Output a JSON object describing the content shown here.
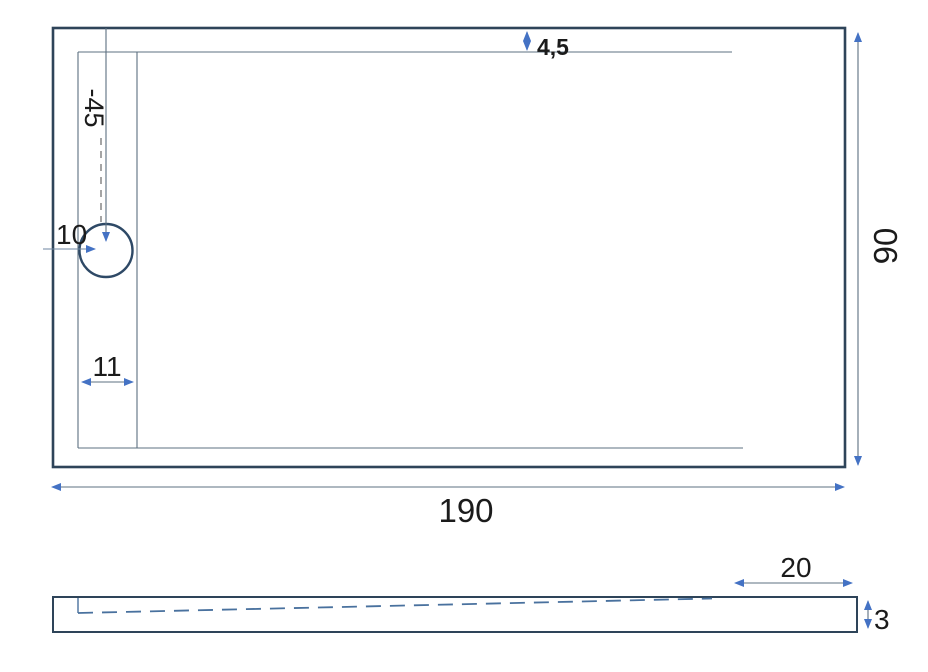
{
  "drawing": {
    "title": "shower-tray-dimension-drawing",
    "views": [
      "top-view",
      "side-profile-view"
    ]
  },
  "top_view": {
    "dim_rim_offset": "4,5",
    "dim_drain_vertical": "-45",
    "dim_drain_horizontal": "10",
    "dim_channel": "11",
    "dim_width": "190",
    "dim_depth": "90"
  },
  "side_view": {
    "dim_flat_zone": "20",
    "dim_thickness": "3"
  },
  "colors": {
    "outline_dark": "#2E4459",
    "line_muted": "#5C7080",
    "arrow_accent": "#4472C4",
    "slope_dashed": "#49719E",
    "aux_dash": "#4B4B4B",
    "text": "#1B1B1B",
    "background": "#FFFFFF"
  },
  "icons": {
    "arrowhead": "filled-triangle"
  }
}
